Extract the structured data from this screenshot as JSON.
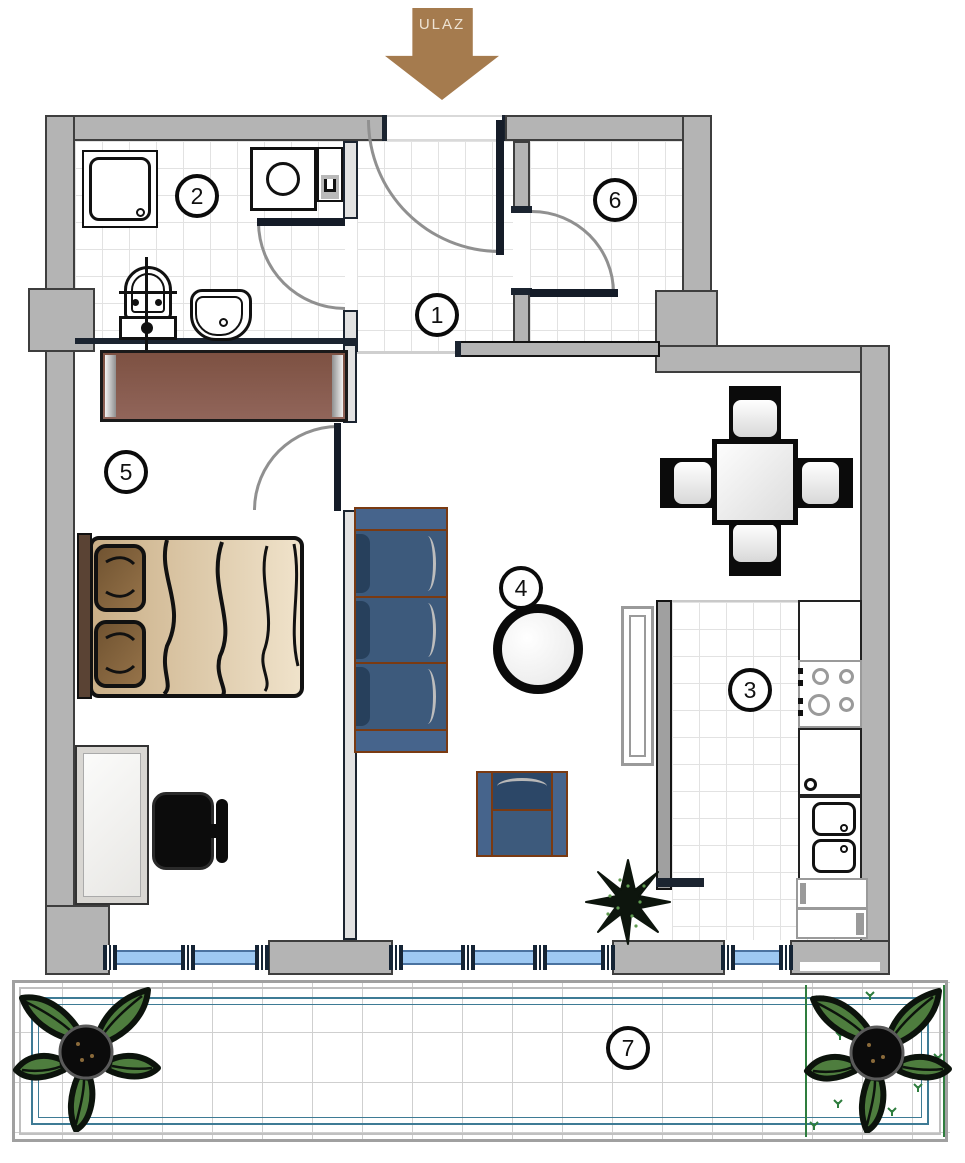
{
  "plan": {
    "title": "apartment-floor-plan",
    "entrance_label": "ULAZ",
    "rooms": [
      {
        "number": "1"
      },
      {
        "number": "2"
      },
      {
        "number": "3"
      },
      {
        "number": "4"
      },
      {
        "number": "5"
      },
      {
        "number": "6"
      },
      {
        "number": "7"
      }
    ],
    "colors": {
      "wall_fill": "#b4b4b4",
      "wall_edge": "#3e3e3e",
      "partition_dark": "#1b2430",
      "entrance_arrow_brown": "#a57b4e",
      "wardrobe_brown": "#855a48",
      "sofa_blue": "#3d5a7c",
      "sofa_trim_brown": "#7a3a12",
      "bed_beige": "#e5d3b3",
      "pillow_brown": "#8a6a44",
      "window_glass_blue": "#9dc8f2",
      "railing_teal": "#3e7b95",
      "plant_green": "#4e7d3e",
      "tile_line": "#e2e2e2"
    }
  }
}
